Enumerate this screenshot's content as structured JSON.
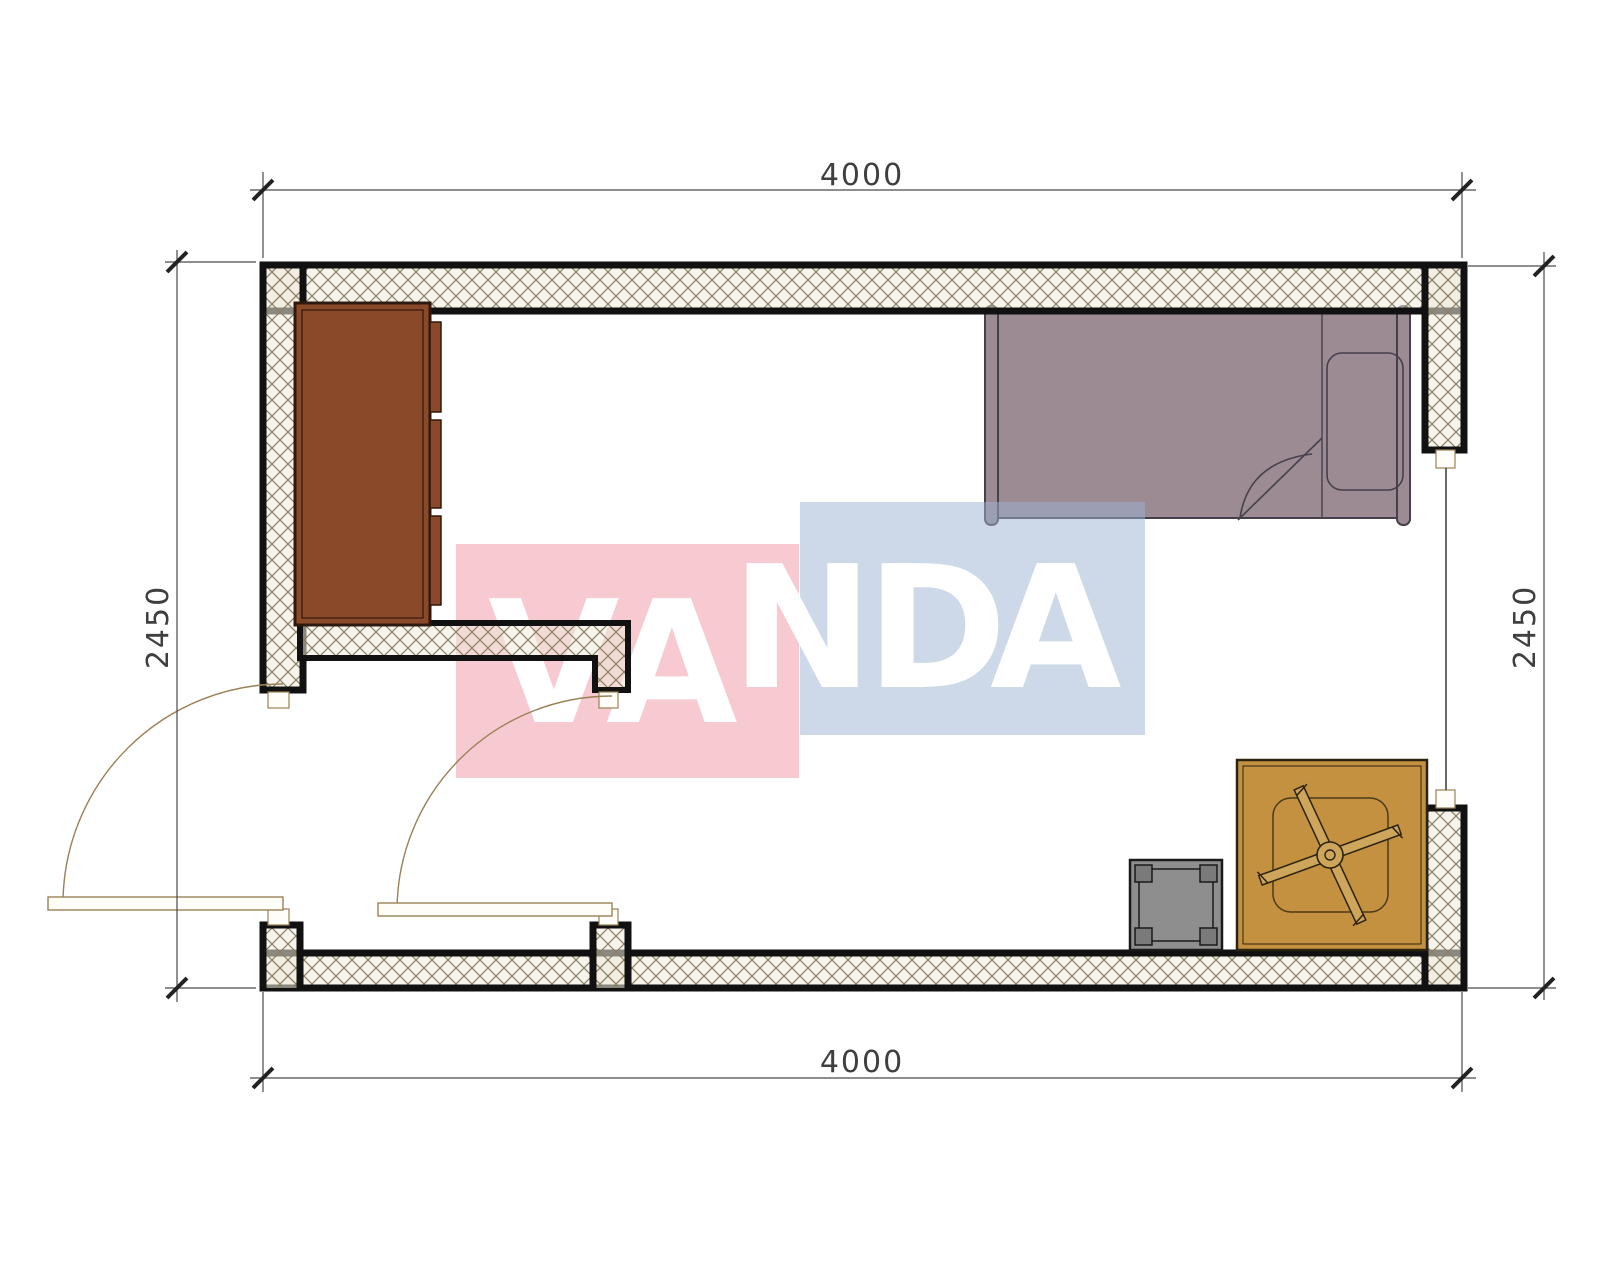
{
  "document": {
    "type": "architectural-floor-plan"
  },
  "dimensions": {
    "top": "4000",
    "bottom": "4000",
    "left": "2450",
    "right": "2450"
  },
  "watermark": {
    "text": "VANDA",
    "letters": [
      "V",
      "A",
      "N",
      "D",
      "A"
    ],
    "pink_color": "#ee96a2",
    "blue_color": "#9bb3d3",
    "letter_color": "#ffffff"
  },
  "room": {
    "furniture": [
      {
        "name": "wardrobe-dresser",
        "color": "#8a4a29"
      },
      {
        "name": "single-bed-with-pillow",
        "color": "#9c8b93"
      },
      {
        "name": "square-table-with-ceiling-fan",
        "color": "#c39140"
      },
      {
        "name": "stool",
        "color": "#8e8e8e"
      }
    ],
    "openings": {
      "doors": 2,
      "windows": 1
    }
  },
  "colors": {
    "wall_line": "#111111",
    "hatch_line": "#8a7f66",
    "hatch_fill": "#efe9d8",
    "dim_line": "#4a4a4a",
    "dim_text": "#3f3f3f",
    "door_line": "#9a8055",
    "bed": "#9c8b93",
    "bed_line": "#46404c",
    "cabinet": "#8a4a29",
    "cabinet_line": "#30180c",
    "table": "#c39140",
    "table_line": "#2c2210",
    "fan_blade": "#cda65c",
    "stool": "#8e8e8e",
    "stool_leg": "#7a7a7a",
    "stool_line": "#1a1a1a",
    "window_glass": "#444444"
  }
}
